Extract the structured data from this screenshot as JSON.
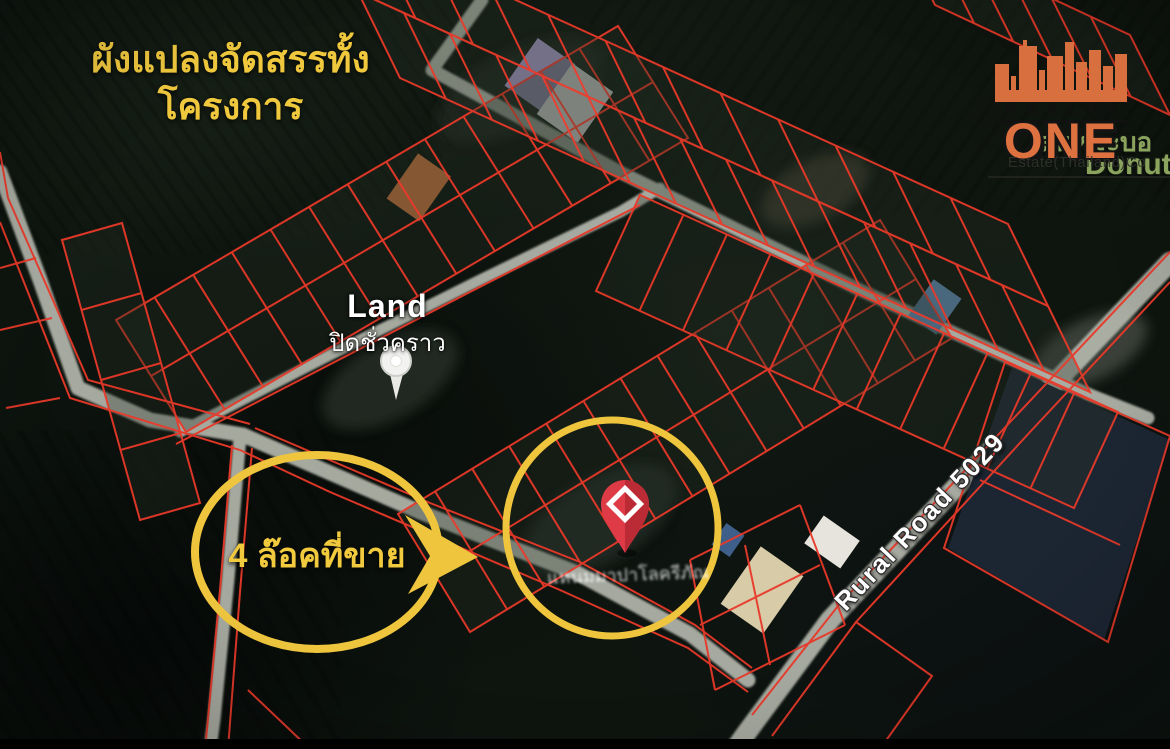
{
  "annotation": {
    "title_line1": "ผังแปลงจัดสรรทั้ง",
    "title_line2": "โครงการ",
    "callout_text": "4 ล๊อคที่ขาย"
  },
  "map_labels": {
    "land_name": "Land",
    "land_status": "ปิดชั่วคราว",
    "road_name": "Rural Road 5029",
    "place_thai_partial": "ลนหมะบอ",
    "place_latin_partial": "DonutC",
    "pin_area_label_blurry": "แหนมมาปาโลครีภัณ"
  },
  "logo": {
    "brand_top": "REALTY",
    "brand_main": "ONE",
    "subtitle": "Estate(Thailand)Co"
  },
  "colors": {
    "annotation_yellow": "#efc83e",
    "plot_line_red": "#e8392a",
    "logo_orange": "#dd7140",
    "map_label_green": "#8aa35d",
    "pin_red": "#df3b47"
  }
}
